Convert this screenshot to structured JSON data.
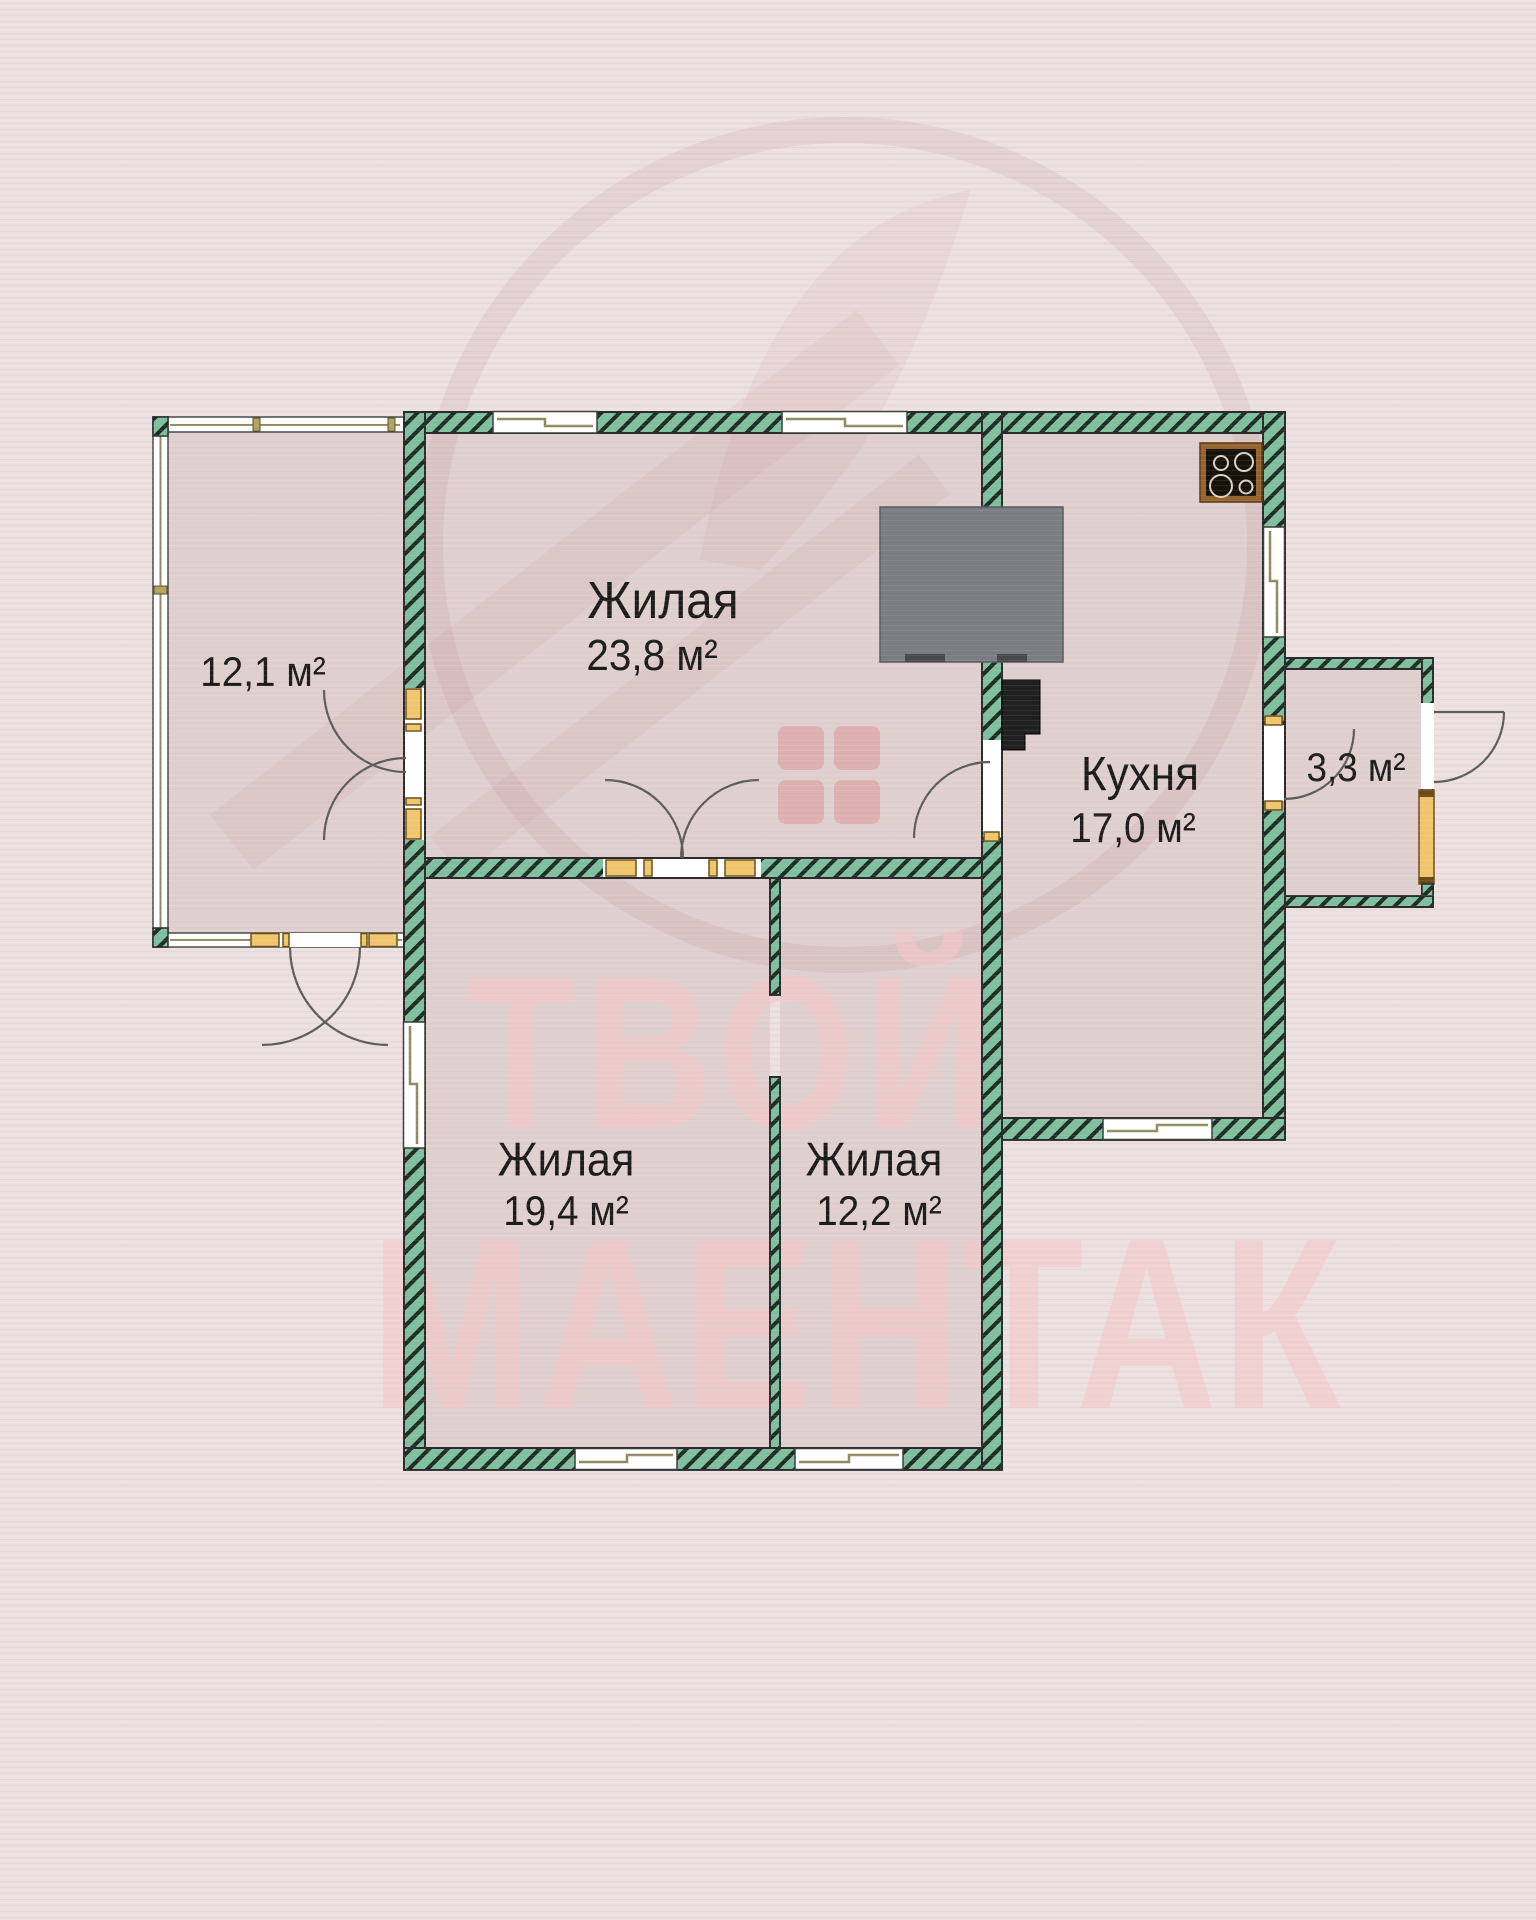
{
  "plan": {
    "rooms": [
      {
        "id": "living-top",
        "name": "Жилая",
        "area": "23,8 м²"
      },
      {
        "id": "kitchen",
        "name": "Кухня",
        "area": "17,0 м²"
      },
      {
        "id": "living-left",
        "name": "Жилая",
        "area": "19,4 м²"
      },
      {
        "id": "living-mid",
        "name": "Жилая",
        "area": "12,2 м²"
      },
      {
        "id": "veranda",
        "name": "",
        "area": "12,1 м²"
      },
      {
        "id": "annex",
        "name": "",
        "area": "3,3 м²"
      }
    ],
    "units": "м²"
  },
  "watermark": {
    "line1": "ТВОЙ",
    "line2": "МАЕНТАК"
  },
  "icons": {
    "cooktop-icon": "black square with 4 burner circles in brown frame",
    "stove-icon": "large gray masonry stove block on wall",
    "boiler-icon": "small black boiler rectangle on kitchen wall",
    "door-arc-icon": "quarter-circle door swing arc",
    "window-icon": "white gap in wall with stepped olive sill line"
  },
  "colors": {
    "background": "#ecdfdf",
    "floor": "#e2d2d2",
    "wall_green": "#7fbf9e",
    "wall_hatch": "#1e2d24",
    "door_jamb_yellow": "#efc56d",
    "window_sill_olive": "#8f8a5f",
    "stove_gray": "#7a7d81",
    "cooktop_frame_brown": "#96642e",
    "watermark_pink": "#f3c6c6",
    "watermark_red": "#9b4b4b"
  }
}
